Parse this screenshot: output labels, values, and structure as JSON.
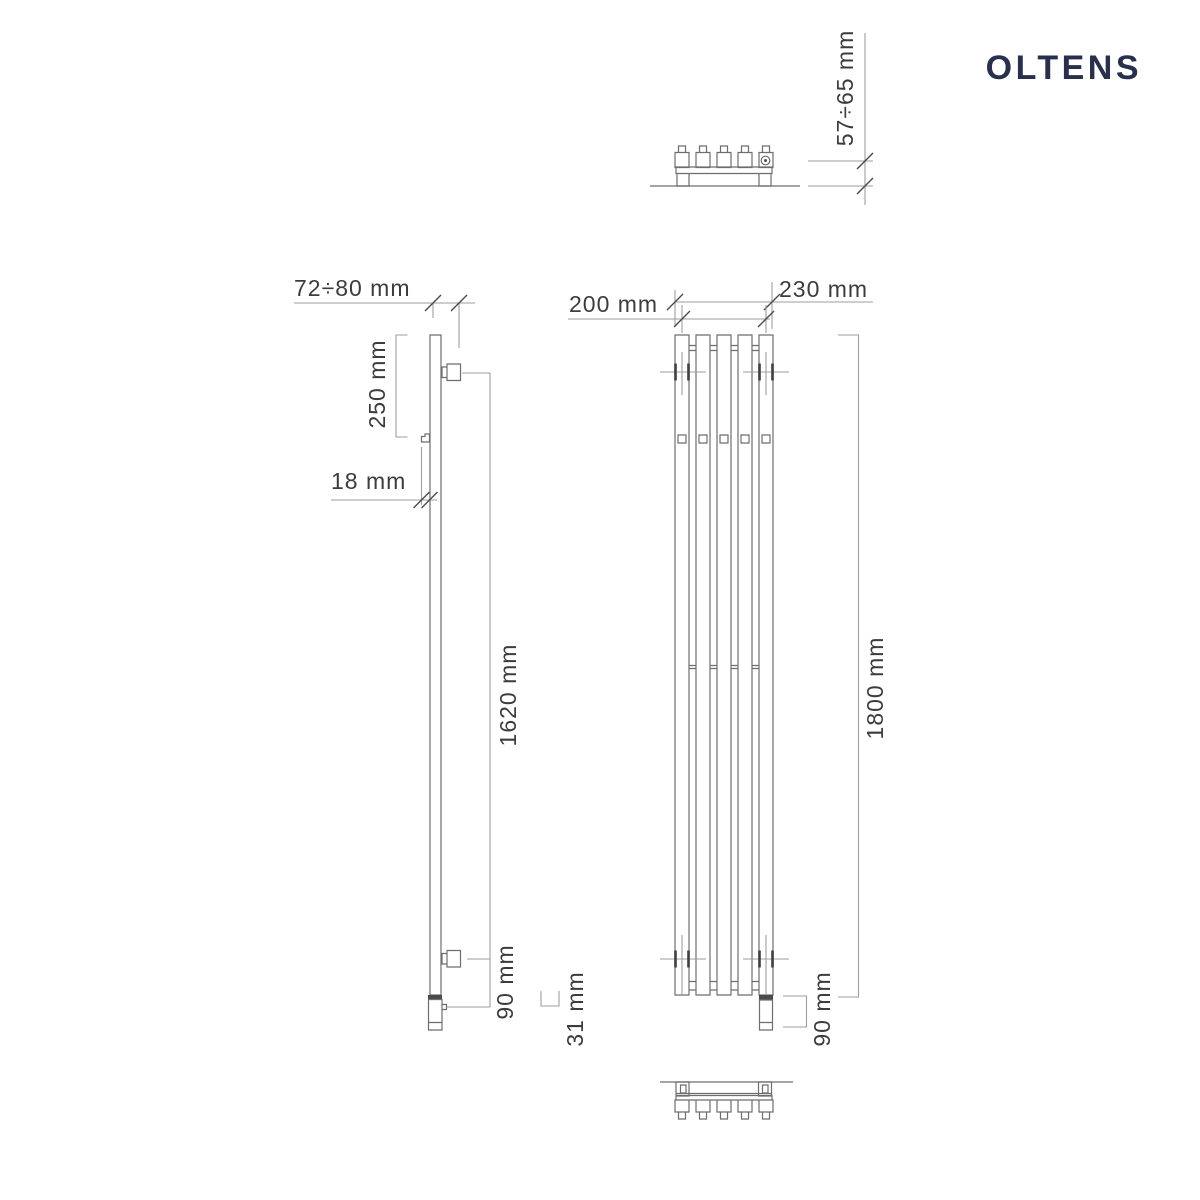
{
  "brand": {
    "name": "OLTENS",
    "color": "#28304d"
  },
  "diagram": {
    "line_color": "#6e6e6e",
    "dimension_line_color": "#9e9e9e",
    "text_color": "#3c3c3c",
    "dimensions": {
      "top_view_wall_distance": "57÷65 mm",
      "side_depth_range": "72÷80 mm",
      "side_top_mount_offset": "250 mm",
      "side_hook_clearance": "18 mm",
      "side_mount_span": "1620 mm",
      "side_bottom_offset": "90 mm",
      "side_element_protrusion": "31 mm",
      "front_connection_spacing": "200 mm",
      "front_overall_width": "230 mm",
      "front_overall_height": "1800 mm",
      "front_bottom_offset": "90 mm"
    }
  }
}
